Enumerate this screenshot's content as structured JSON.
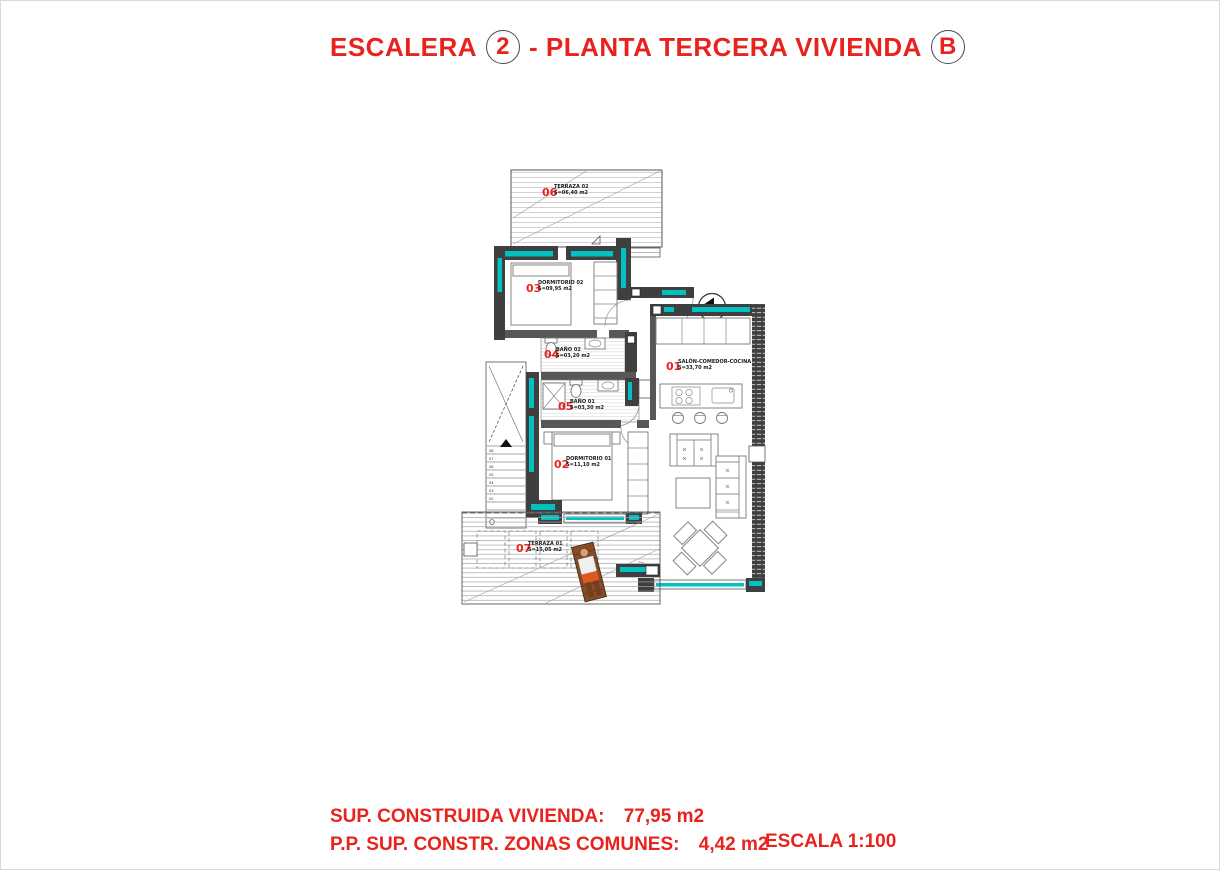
{
  "title": {
    "prefix": "ESCALERA",
    "stair_number": "2",
    "middle": "- PLANTA TERCERA VIVIENDA",
    "unit_letter": "B"
  },
  "plan": {
    "entry_marker": "B",
    "rooms": [
      {
        "number": "01",
        "name": "SALÓN-COMEDOR-COCINA",
        "area": "S=33,70 m2"
      },
      {
        "number": "02",
        "name": "DORMITORIO 01",
        "area": "S=11,10 m2"
      },
      {
        "number": "03",
        "name": "DORMITORIO 02",
        "area": "S=09,95 m2"
      },
      {
        "number": "04",
        "name": "BAÑO 02",
        "area": "S=03,20 m2"
      },
      {
        "number": "05",
        "name": "BAÑO 01",
        "area": "S=03,30 m2"
      },
      {
        "number": "06",
        "name": "TERRAZA 02",
        "area": "S=06,40 m2"
      },
      {
        "number": "07",
        "name": "TERRAZA 01",
        "area": "S=15,05 m2"
      }
    ],
    "stairs": {
      "steps": [
        "08",
        "07",
        "06",
        "05",
        "04",
        "03",
        "02"
      ]
    }
  },
  "footer": {
    "line1_label": "SUP. CONSTRUIDA VIVIENDA:",
    "line1_value": "77,95 m2",
    "line2_label": "P.P. SUP. CONSTR. ZONAS COMUNES:",
    "line2_value": "4,42 m2",
    "scale_label": "ESCALA 1:100"
  },
  "colors": {
    "accent_red": "#e8231d",
    "wall_dark": "#3f3f3f",
    "glass_teal": "#00c2c2"
  }
}
